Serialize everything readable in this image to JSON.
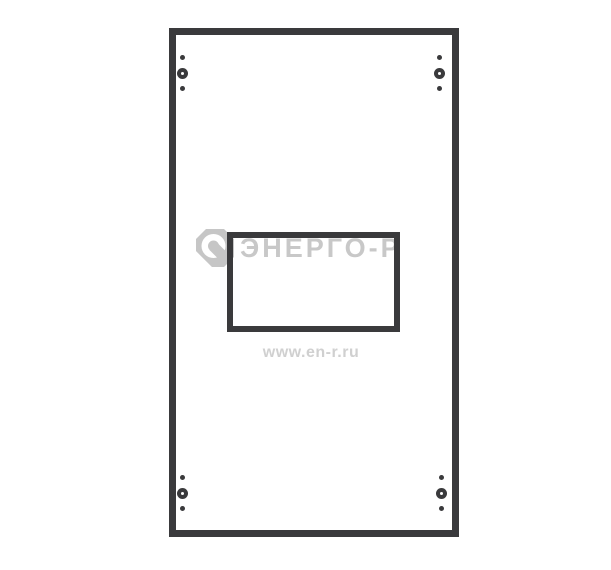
{
  "page": {
    "background": "#ffffff"
  },
  "colors": {
    "line": "#3a3a3c",
    "watermark_text": "#c8c8c8",
    "watermark_url": "#d0d0d0",
    "watermark_logo": "#c6c6c6",
    "page_background": "#ffffff"
  },
  "diagram": {
    "type": "technical-line-drawing",
    "subject": "panel front view with rectangular cutout window and four corner fasteners",
    "outer_panel": {
      "left": 169,
      "top": 28,
      "width": 290,
      "height": 509,
      "stroke": 7
    },
    "cutout_window": {
      "left": 227,
      "top": 232,
      "width": 173,
      "height": 100,
      "stroke": 6
    },
    "fasteners": [
      {
        "position": "top-left",
        "left": 177,
        "top": 55
      },
      {
        "position": "top-right",
        "left": 434,
        "top": 55
      },
      {
        "position": "bottom-left",
        "left": 177,
        "top": 475
      },
      {
        "position": "bottom-right",
        "left": 436,
        "top": 475
      }
    ]
  },
  "watermark": {
    "brand_text": "ЭНЕРГО-Р",
    "site_url": "www.en-r.ru",
    "logo_box": {
      "left": 195,
      "top": 228,
      "width": 40,
      "height": 40
    },
    "brand_box": {
      "left": 240,
      "top": 232
    },
    "url_box": {
      "left": 239,
      "top": 344,
      "width": 144
    }
  }
}
